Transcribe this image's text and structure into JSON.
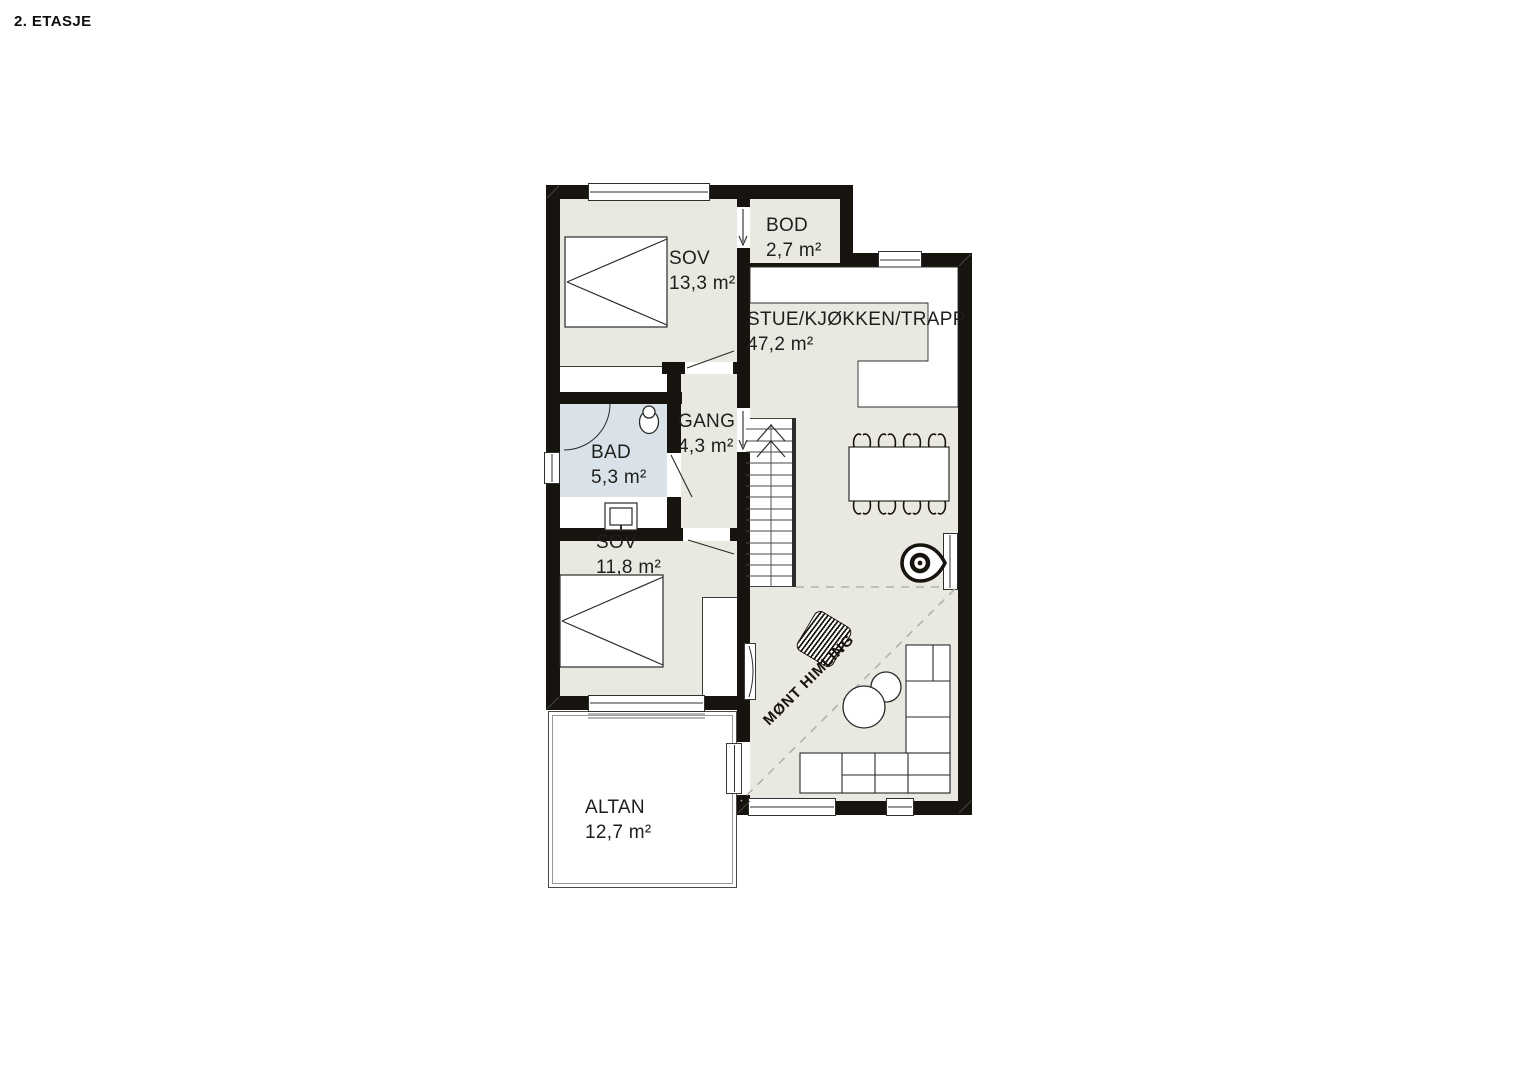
{
  "title": "2. ETASJE",
  "rooms": {
    "sov1": {
      "name": "SOV",
      "area": "13,3 m²"
    },
    "bod": {
      "name": "BOD",
      "area": "2,7 m²"
    },
    "stue": {
      "name": "STUE/KJØKKEN/TRAPP",
      "area": "47,2 m²"
    },
    "gang": {
      "name": "GANG",
      "area": "4,3 m²"
    },
    "bad": {
      "name": "BAD",
      "area": "5,3 m²"
    },
    "sov2": {
      "name": "SOV",
      "area": "11,8 m²"
    },
    "altan": {
      "name": "ALTAN",
      "area": "12,7 m²"
    }
  },
  "annotations": {
    "ceiling_note": "MØNT HIMLING"
  },
  "colors": {
    "wall": "#17130e",
    "floor": "#e9e8e1",
    "bath_floor": "#d9e2e8",
    "line": "#2a2a28",
    "dash": "#b3b2ac"
  }
}
